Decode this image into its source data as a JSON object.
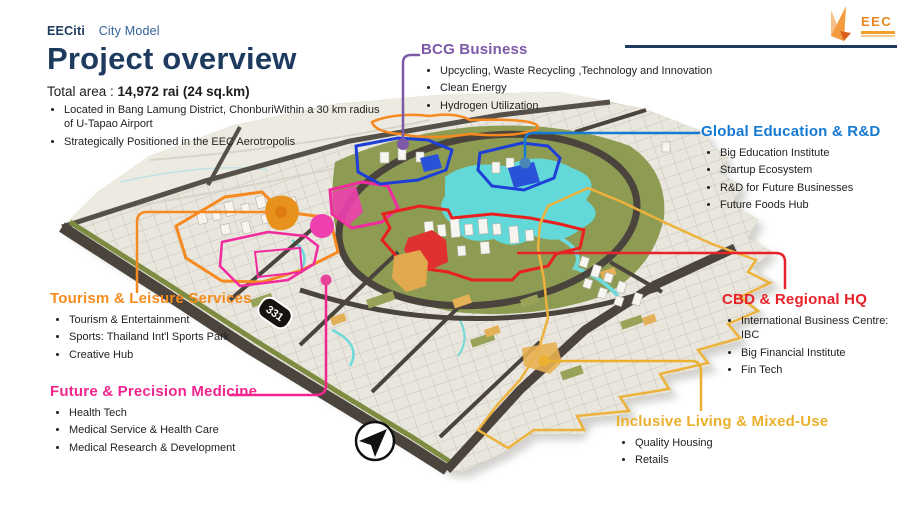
{
  "meta": {
    "brand": "EECiti",
    "breadcrumb": "City Model"
  },
  "header": {
    "title": "Project overview",
    "total_area_label": "Total area : ",
    "total_area_value": "14,972 rai (24 sq.km)",
    "bullets": [
      "Located in Bang Lamung District, ChonburiWithin a 30 km radius of U-Tapao Airport",
      "Strategically Positioned in the EEC Aerotropolis"
    ]
  },
  "logo": {
    "text": "EEC"
  },
  "callouts": [
    {
      "id": "bcg",
      "label": "BCG Business",
      "color": "#7c5aa8",
      "items": [
        "Upcycling, Waste Recycling ,Technology and Innovation",
        "Clean Energy",
        "Hydrogen Utilization"
      ]
    },
    {
      "id": "education",
      "label": "Global Education & R&D",
      "color": "#1679d2",
      "items": [
        "Big Education Institute",
        "Startup Ecosystem",
        "R&D for Future Businesses",
        "Future Foods Hub"
      ]
    },
    {
      "id": "cbd",
      "label": "CBD & Regional HQ",
      "color": "#e8222a",
      "items": [
        "International Business Centre: IBC",
        "Big Financial Institute",
        "Fin Tech"
      ]
    },
    {
      "id": "tourism",
      "label": "Tourism & Leisure Services",
      "color": "#f68b1e",
      "items": [
        "Tourism & Entertainment",
        "Sports: Thailand Int'l Sports Park",
        "Creative Hub"
      ]
    },
    {
      "id": "medicine",
      "label": "Future & Precision Medicine",
      "color": "#f2258f",
      "items": [
        "Health Tech",
        "Medical Service & Health Care",
        "Medical Research & Development"
      ]
    },
    {
      "id": "living",
      "label": "Inclusive Living & Mixed-Use",
      "color": "#eab02e",
      "items": [
        "Quality Housing",
        "Retails"
      ]
    }
  ],
  "map": {
    "road_badge": "331",
    "colors": {
      "land_olive": "#8e9b52",
      "lake_cyan": "#63d8d8",
      "road_dark": "#4a443d",
      "blocks": "#e9e6de",
      "plain": "#edeae1",
      "gold_buildings": "#e2a84e"
    }
  }
}
